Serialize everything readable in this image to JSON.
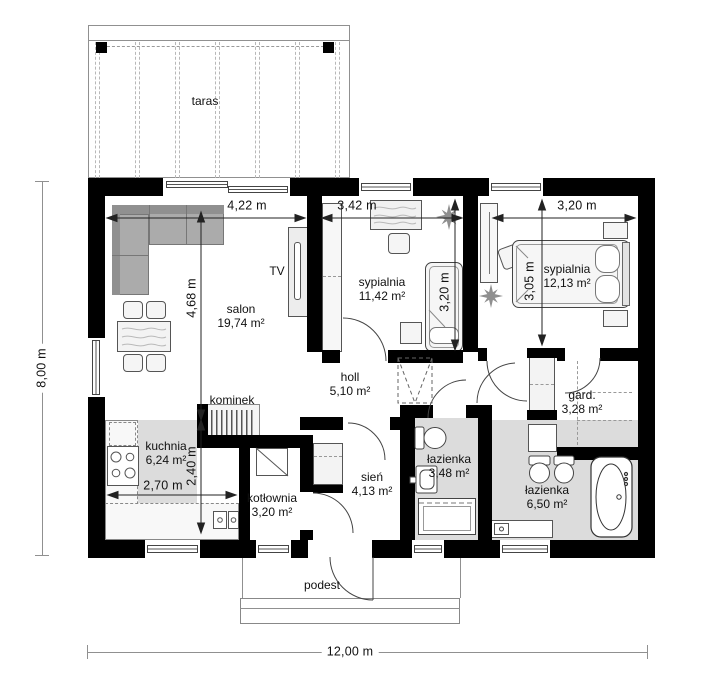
{
  "plan": {
    "labels": {
      "taras": "taras",
      "podest": "podest",
      "kominek": "kominek",
      "tv": "TV"
    },
    "rooms": {
      "salon": {
        "name": "salon",
        "area": "19,74 m²"
      },
      "sypialnia1": {
        "name": "sypialnia",
        "area": "11,42 m²"
      },
      "sypialnia2": {
        "name": "sypialnia",
        "area": "12,13 m²"
      },
      "holl": {
        "name": "holl",
        "area": "5,10 m²"
      },
      "kuchnia": {
        "name": "kuchnia",
        "area": "6,24 m²"
      },
      "kotlownia": {
        "name": "kotłownia",
        "area": "3,20 m²"
      },
      "sien": {
        "name": "sień",
        "area": "4,13 m²"
      },
      "lazienka_mala": {
        "name": "łazienka",
        "area": "3,48 m²"
      },
      "lazienka_duza": {
        "name": "łazienka",
        "area": "6,50 m²"
      },
      "garderoba": {
        "name": "gard.",
        "area": "3,28 m²"
      }
    },
    "dimensions": {
      "total_width": "12,00 m",
      "total_height": "8,00 m",
      "salon_width": "4,22 m",
      "salon_height": "4,68 m",
      "sypialnia1_width": "3,42 m",
      "sypialnia1_height": "3,20 m",
      "sypialnia2_width": "3,20 m",
      "sypialnia2_height": "3,05 m",
      "kuchnia_width": "2,70 m",
      "kuchnia_height": "2,40 m"
    },
    "colors": {
      "wall": "#000000",
      "wet_floor": "#dcdcdc",
      "sofa": "#ababab"
    }
  }
}
